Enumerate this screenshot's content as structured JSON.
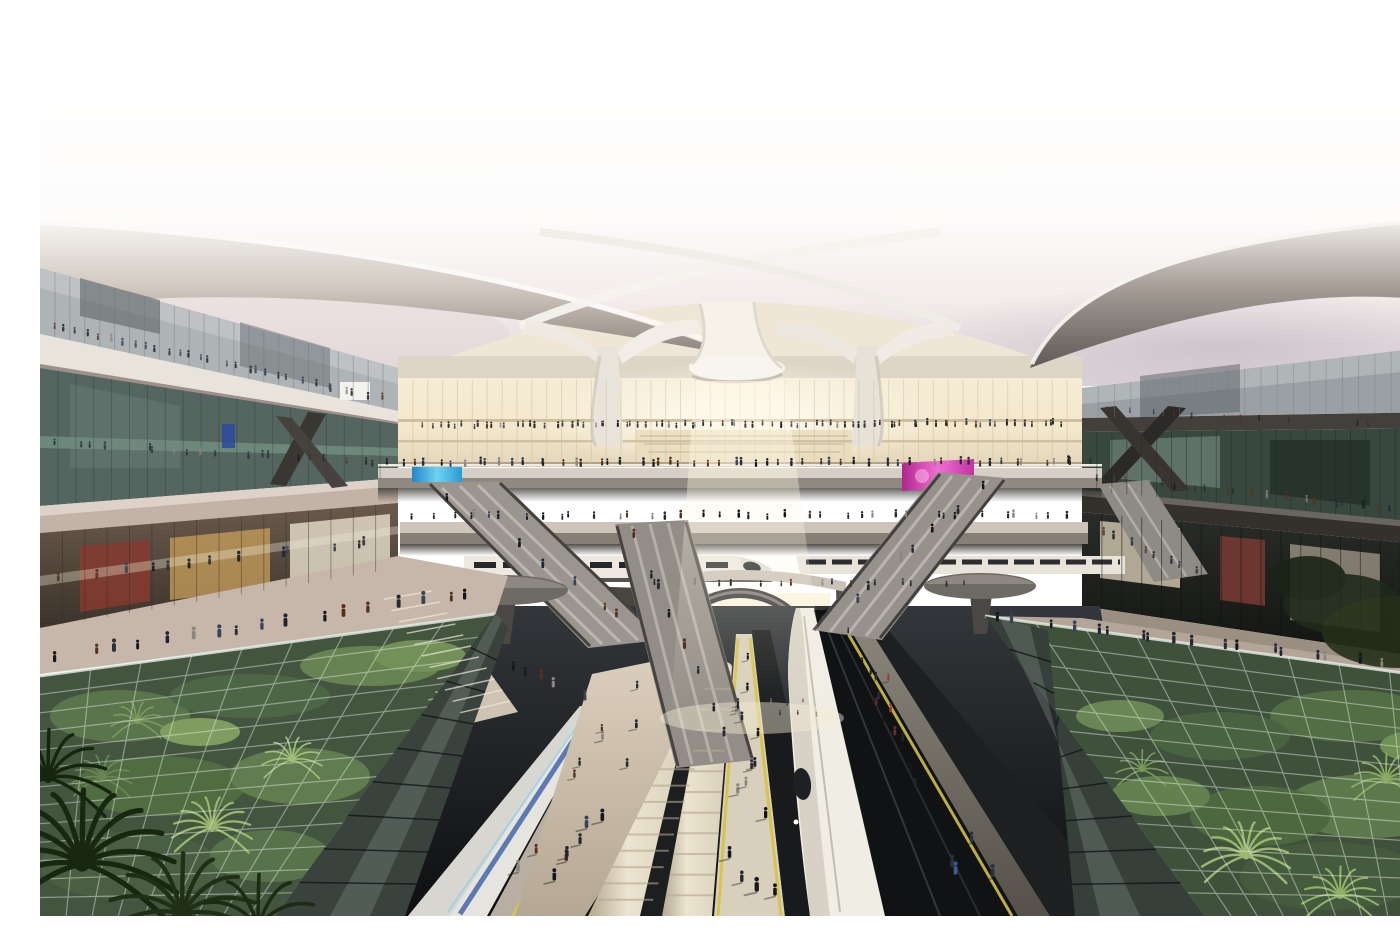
{
  "meta": {
    "title": "Futuristic high-speed railway terminal — architectural rendering",
    "view": "elevated interior view toward the grand hall",
    "alt": "Elevated view inside a futuristic rail terminal: sweeping white canopy wings on trumpet-shaped columns over a glowing atrium, multi-level glass concourses crowded with people, criss-crossing escalators and bridges, white high-speed trains at radiating platforms, and glass-roofed tropical gardens flanking the tracks, palms in the foreground."
  },
  "palette": {
    "sky_top": "#ffffff",
    "sky_horizon_pink": "#e8dfe0",
    "sky_horizon_lavender": "#cfc8d4",
    "canopy_white": "#f2efe9",
    "canopy_shadow": "#8d867e",
    "wing_underside_dark": "#5f5a56",
    "concrete_slab": "#b5a69c",
    "fascia_white": "#e8e3db",
    "glass_teal": "#66807a",
    "glass_dark": "#2c3331",
    "atrium_glow": "#f8efd8",
    "storefront_warm": "#caa05c",
    "storefront_red": "#8a3a30",
    "bridge_deck": "#d5cfc5",
    "escalator_gray": "#94908a",
    "train_white": "#f0ede5",
    "train_cream": "#e9e1cf",
    "train_blue_stripe": "#3a5fa8",
    "train_window": "#26282b",
    "platform_beige": "#d3c8b6",
    "safety_yellow": "#d6c44c",
    "track_dark": "#17191b",
    "garden_green": "#3f5c2c",
    "garden_highlight": "#8fae58",
    "palm_dark": "#1c2d13",
    "glass_canopy_tint": "#c6d8ce",
    "led_blue": "#35b6e0",
    "led_magenta": "#d83ab0",
    "led_red": "#b8434a",
    "person_dark": "#1c1e22"
  },
  "scene_regions": [
    {
      "name": "roof-wing-left",
      "label": "sweeping white roof wing, left"
    },
    {
      "name": "roof-wing-right",
      "label": "sweeping roof wing, right"
    },
    {
      "name": "canopy-columns",
      "label": "trumpet-shaped canopy columns"
    },
    {
      "name": "atrium-facade",
      "label": "glowing glass grand hall"
    },
    {
      "name": "concourse-left",
      "label": "multi-level glass concourse, left"
    },
    {
      "name": "concourse-right",
      "label": "multi-level glass concourse, right"
    },
    {
      "name": "bridges-escalators",
      "label": "walkway bridges and escalators"
    },
    {
      "name": "trains-platforms",
      "label": "high-speed trains and platforms"
    },
    {
      "name": "garden-canopies",
      "label": "glass-roofed gardens"
    },
    {
      "name": "foreground-palms",
      "label": "foreground palm fronds"
    }
  ],
  "people": {
    "rows": [
      {
        "x1": 382,
        "y1": 412,
        "x2": 1028,
        "y2": 410,
        "n": 85,
        "h": 6,
        "seed": 11,
        "op": 0.9
      },
      {
        "x1": 345,
        "y1": 450,
        "x2": 1055,
        "y2": 449,
        "n": 58,
        "h": 7,
        "seed": 12,
        "op": 1
      },
      {
        "x1": 368,
        "y1": 503,
        "x2": 1040,
        "y2": 502,
        "n": 38,
        "h": 7,
        "seed": 13,
        "op": 1
      },
      {
        "x1": 12,
        "y1": 313,
        "x2": 345,
        "y2": 386,
        "n": 30,
        "h": 7,
        "seed": 14,
        "op": 0.8
      },
      {
        "x1": 10,
        "y1": 430,
        "x2": 345,
        "y2": 450,
        "n": 20,
        "h": 7,
        "seed": 15,
        "op": 0.7
      },
      {
        "x1": 1052,
        "y1": 464,
        "x2": 1392,
        "y2": 500,
        "n": 22,
        "h": 7,
        "seed": 16,
        "op": 0.75
      },
      {
        "x1": 1060,
        "y1": 396,
        "x2": 1392,
        "y2": 416,
        "n": 15,
        "h": 6,
        "seed": 17,
        "op": 0.7
      },
      {
        "x1": 950,
        "y1": 606,
        "x2": 1395,
        "y2": 656,
        "n": 20,
        "h": 10,
        "seed": 18,
        "op": 1
      },
      {
        "x1": 12,
        "y1": 646,
        "x2": 445,
        "y2": 580,
        "n": 17,
        "h": 11,
        "seed": 19,
        "op": 1
      },
      {
        "x1": 15,
        "y1": 566,
        "x2": 350,
        "y2": 528,
        "n": 13,
        "h": 9,
        "seed": 20,
        "op": 0.85
      },
      {
        "x1": 612,
        "y1": 570,
        "x2": 928,
        "y2": 570,
        "n": 16,
        "h": 6,
        "seed": 21,
        "op": 0.9
      },
      {
        "x1": 402,
        "y1": 480,
        "x2": 598,
        "y2": 616,
        "n": 7,
        "h": 8,
        "seed": 22,
        "op": 1
      },
      {
        "x1": 592,
        "y1": 516,
        "x2": 688,
        "y2": 728,
        "n": 8,
        "h": 9,
        "seed": 23,
        "op": 1
      },
      {
        "x1": 948,
        "y1": 470,
        "x2": 804,
        "y2": 598,
        "n": 7,
        "h": 8,
        "seed": 24,
        "op": 1
      },
      {
        "x1": 470,
        "y1": 652,
        "x2": 552,
        "y2": 688,
        "n": 6,
        "h": 9,
        "seed": 25,
        "op": 1
      },
      {
        "x1": 1060,
        "y1": 518,
        "x2": 1160,
        "y2": 560,
        "n": 8,
        "h": 8,
        "seed": 26,
        "op": 0.8
      }
    ],
    "traps": [
      {
        "tx": 704,
        "ty": 632,
        "tw": 10,
        "bx": 708,
        "by": 893,
        "bw": 58,
        "n": 16,
        "h1": 6,
        "h2": 13,
        "seed": 31,
        "sh": true
      },
      {
        "tx": 600,
        "ty": 668,
        "tw": 46,
        "bx": 512,
        "by": 893,
        "bw": 58,
        "n": 10,
        "h1": 7,
        "h2": 13,
        "seed": 32,
        "sh": true
      },
      {
        "tx": 812,
        "ty": 614,
        "tw": 14,
        "bx": 945,
        "by": 893,
        "bw": 72,
        "n": 17,
        "h1": 6,
        "h2": 13,
        "seed": 33,
        "sh": true,
        "colors": [
          "#1a1c20",
          "#23262e",
          "#a0352c",
          "#3e5a96",
          "#14161a",
          "#d8d0c4",
          "#6e2d28",
          "#2c3040"
        ]
      },
      {
        "tx": 754,
        "ty": 686,
        "tw": 50,
        "bx": 756,
        "by": 702,
        "bw": 64,
        "n": 6,
        "h1": 4,
        "h2": 5,
        "seed": 34,
        "op": 0.85
      },
      {
        "tx": 566,
        "ty": 702,
        "tw": 8,
        "bx": 462,
        "by": 893,
        "bw": 16,
        "n": 5,
        "h1": 6,
        "h2": 11,
        "seed": 35,
        "sh": true
      }
    ],
    "default_colors": [
      "#17191d",
      "#212430",
      "#2b2e36",
      "#15161a",
      "#3a4258",
      "#55301f",
      "#8a867e",
      "#262a30"
    ]
  },
  "vegetation": {
    "palms_foreground": [
      [
        42,
        848,
        95,
        "#18270f",
        13
      ],
      [
        142,
        898,
        78,
        "#1f3014",
        11
      ],
      [
        8,
        762,
        62,
        "#16250e",
        11
      ],
      [
        218,
        910,
        66,
        "#1b2c11",
        9
      ]
    ],
    "rosettes_left": [
      [
        172,
        812,
        40,
        "#8fae58",
        12
      ],
      [
        332,
        848,
        44,
        "#7da04e",
        12
      ],
      [
        252,
        744,
        30,
        "#9cba66",
        10
      ],
      [
        97,
        706,
        26,
        "#6b8c42",
        10
      ],
      [
        410,
        690,
        24,
        "#87a855",
        10
      ],
      [
        62,
        762,
        30,
        "#55743a",
        10
      ]
    ],
    "rosettes_right": [
      [
        1206,
        840,
        44,
        "#93b05e",
        12
      ],
      [
        1346,
        764,
        34,
        "#7fa04f",
        11
      ],
      [
        1102,
        754,
        26,
        "#6b8c42",
        9
      ],
      [
        1300,
        880,
        38,
        "#88a854",
        11
      ],
      [
        1386,
        706,
        24,
        "#55743a",
        9
      ]
    ]
  },
  "signs": [
    {
      "name": "led-screen-blue",
      "color": "#35b6e0"
    },
    {
      "name": "led-screen-red",
      "color": "#b8434a"
    },
    {
      "name": "led-screen-magenta",
      "color": "#d83ab0"
    },
    {
      "name": "billboard-white-left",
      "color": "#f4f2ec"
    },
    {
      "name": "billboard-white-right",
      "color": "#efede6"
    }
  ]
}
